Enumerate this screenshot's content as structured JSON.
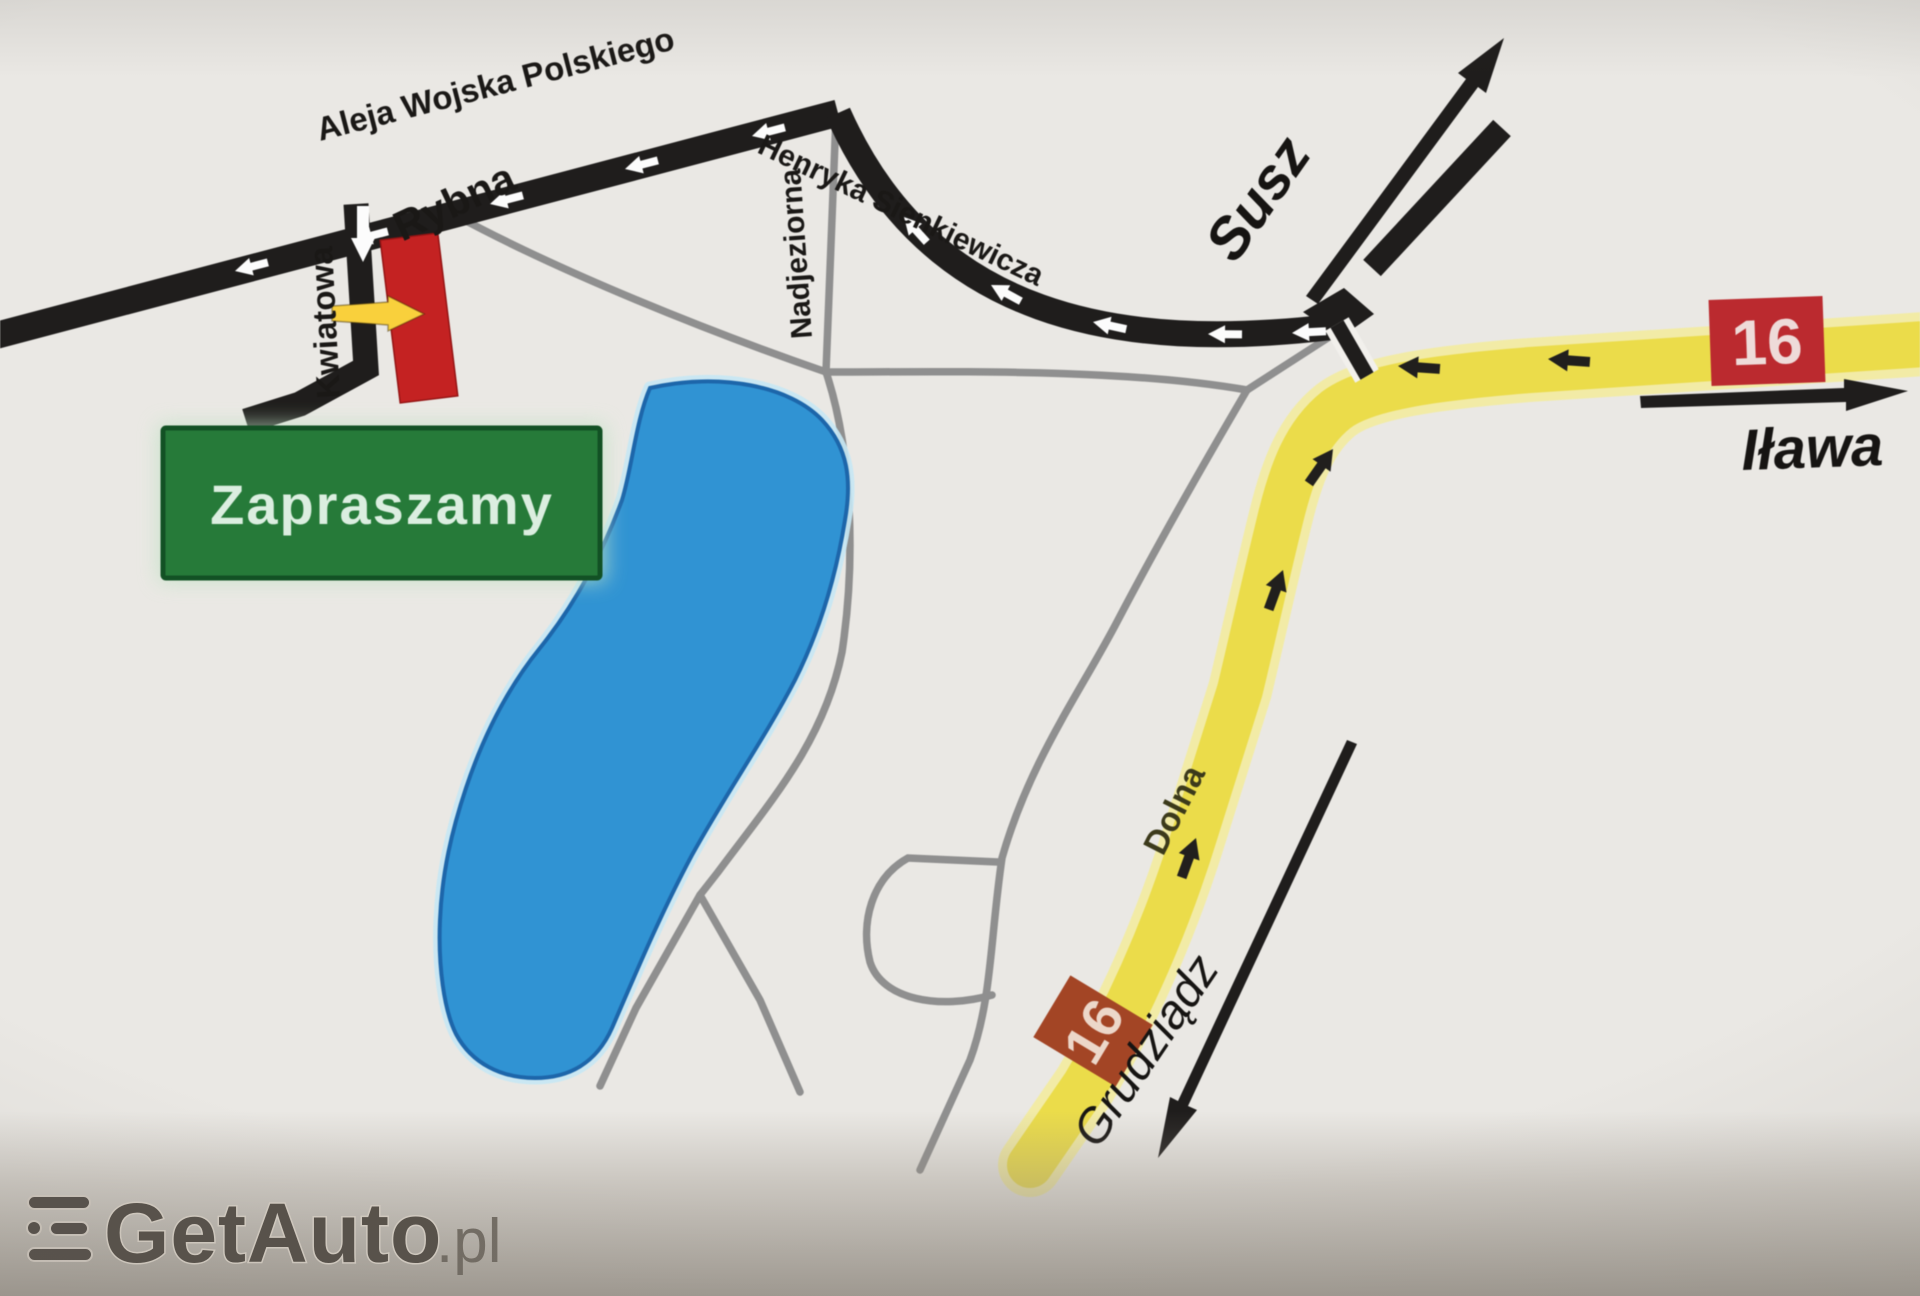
{
  "map": {
    "streets": {
      "aleja_wojska_polskiego": "Aleja Wojska Polskiego",
      "rybna": "Rybna",
      "kwiatowa": "Kwiatowa",
      "nadjeziorna": "Nadjeziorna",
      "henryka_sienkiewicza": "Henryka Sienkiewicza",
      "dolna": "Dolna"
    },
    "destinations": {
      "susz": "Susz",
      "ilawa": "Iława",
      "grudziadz": "Grudziądz"
    },
    "badges": {
      "route_ilawa": "16",
      "route_grudziadz": "16"
    },
    "invite_sign": {
      "label": "Zapraszamy"
    },
    "colors": {
      "road_black": "#1d1b1a",
      "road_gray": "#8f8f8f",
      "route_yellow": "#efdf3d",
      "route_yellow_halo": "#f5eea1",
      "lake_fill": "#2795dc",
      "lake_edge": "#1566b2",
      "lake_halo": "#c5eaf8",
      "invite_green": "#1f7c34",
      "invite_border": "#0c5220",
      "marker_red": "#d11d1d",
      "badge_red": "#c6262b",
      "badge_rust": "#ab421f",
      "entry_arrow_yellow": "#ffd22e"
    },
    "icons": {
      "one_way_arrow": "white-left-arrow",
      "kwiatowa_one_way_arrow": "white-down-arrow",
      "route_direction_arrow": "black-small-arrow",
      "susz_direction_arrow": "black-long-arrow-up-right",
      "ilawa_direction_arrow": "black-arrow-right",
      "grudziadz_direction_arrow": "black-long-arrow-down-left",
      "entrance_arrow": "yellow-arrow-right"
    }
  },
  "watermark": {
    "brand": "GetAuto",
    "tld": ".pl"
  }
}
